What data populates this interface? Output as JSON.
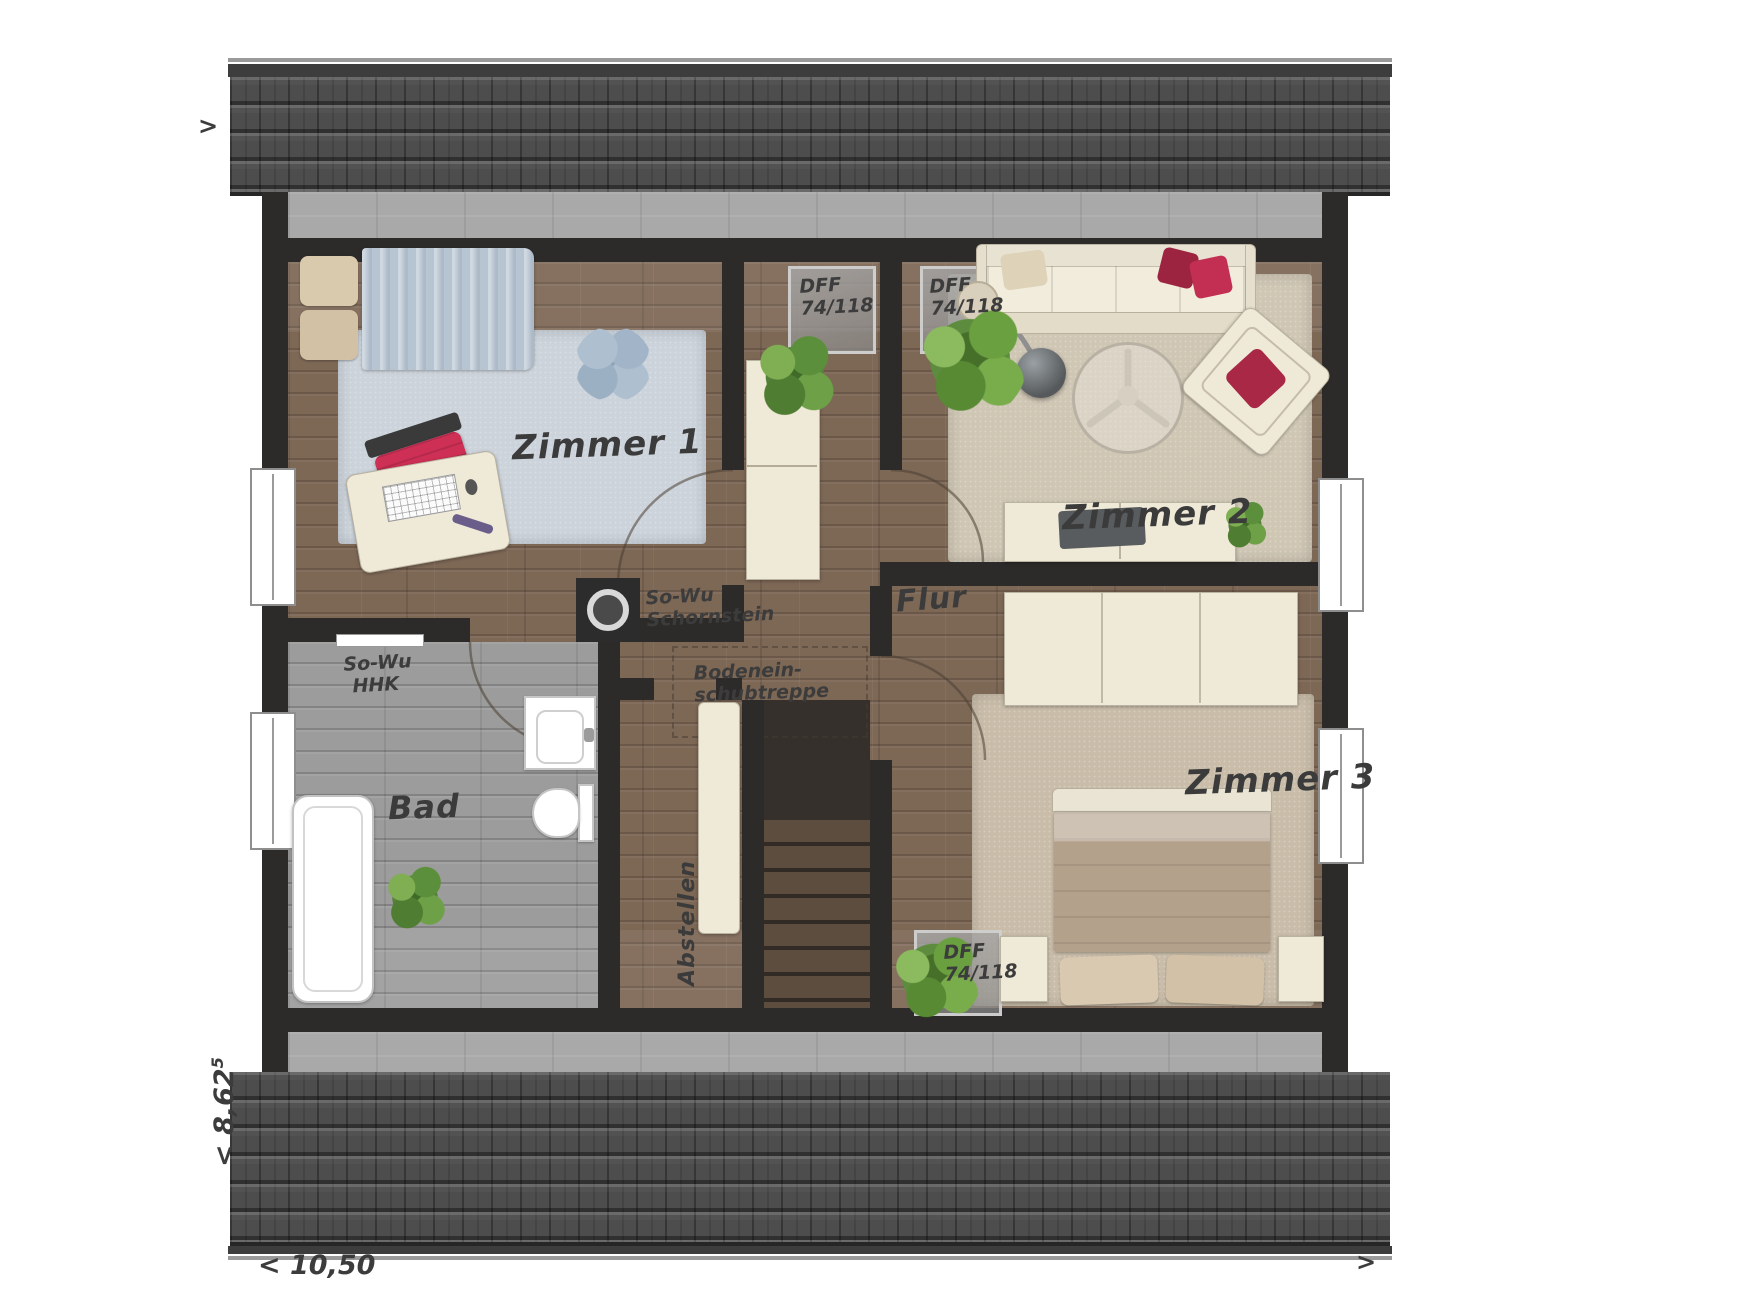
{
  "arrows": {
    "top_left": ">",
    "bottom_right": ">"
  },
  "dimensions": {
    "width_label": "< 10,50",
    "depth_label": "< 8,62",
    "depth_sup": "5"
  },
  "rooms": {
    "zimmer1": "Zimmer 1",
    "zimmer2": "Zimmer 2",
    "zimmer3": "Zimmer 3",
    "bad": "Bad",
    "flur": "Flur",
    "abstellen": "Abstellen"
  },
  "annotations": {
    "skylight1_line1": "DFF",
    "skylight1_line2": "74/118",
    "skylight2_line1": "DFF",
    "skylight2_line2": "74/118",
    "skylight3_line1": "DFF",
    "skylight3_line2": "74/118",
    "chimney_line1": "So-Wu",
    "chimney_line2": "Schornstein",
    "hhk_line1": "So-Wu",
    "hhk_line2": "HHK",
    "loft_line1": "Bodenein-",
    "loft_line2": "schubtreppe"
  },
  "colors": {
    "wall": "#2d2b29",
    "wood_floor": "#7d6755",
    "bath_floor": "#9c9c9c",
    "roof_tiles": "#4d4d4d",
    "furniture_cream": "#efe9d7",
    "accent_red": "#ce2f55",
    "rug_blue": "#ccd3db",
    "rug_beige": "#cfc6b4"
  }
}
